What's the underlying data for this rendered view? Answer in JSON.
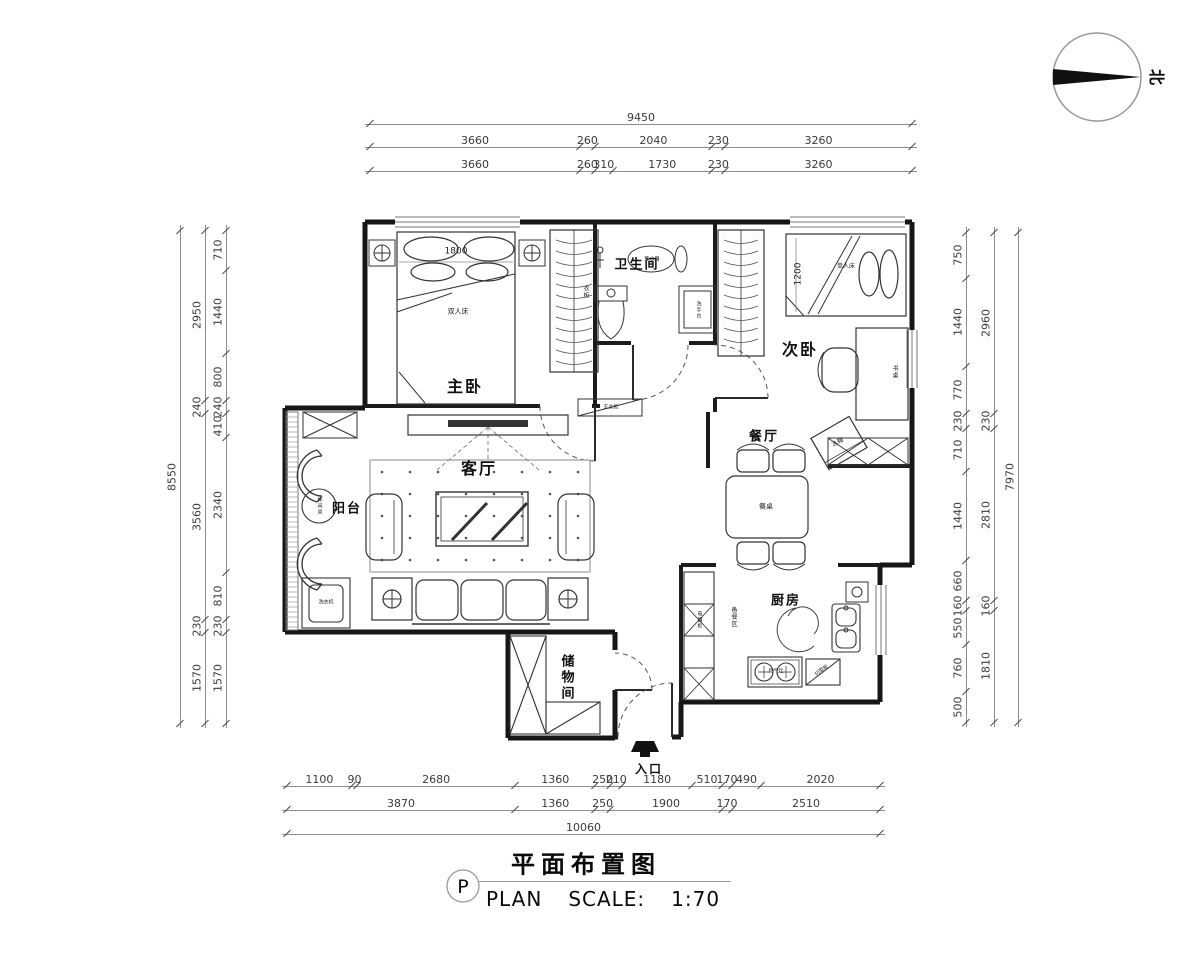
{
  "meta": {
    "background": "#ffffff",
    "ink_color": "#161616",
    "dim_text_color": "#3a3a3a",
    "dim_line_color": "#8c8c8c"
  },
  "north": {
    "label": "北"
  },
  "title_block": {
    "letter": "P",
    "title_cn": "平面布置图",
    "plan_label": "PLAN",
    "scale_label": "SCALE:",
    "scale_value": "1:70"
  },
  "dimensions": {
    "top": {
      "total": [
        "9450"
      ],
      "row2": [
        "3660",
        "260",
        "2040",
        "230",
        "3260"
      ],
      "row3": [
        "3660",
        "260",
        "310",
        "1730",
        "230",
        "3260"
      ]
    },
    "bottom": {
      "row1": [
        "1100",
        "90",
        "2680",
        "1360",
        "250",
        "210",
        "1180",
        "510",
        "170",
        "490",
        "2020"
      ],
      "row2": [
        "3870",
        "1360",
        "250",
        "1900",
        "170",
        "2510"
      ],
      "total": [
        "10060"
      ]
    },
    "left": {
      "total": [
        "8550"
      ],
      "mid": [
        "2950",
        "240",
        "3560",
        "230",
        "1570"
      ],
      "inner": [
        "710",
        "1440",
        "800",
        "240",
        "410",
        "2340",
        "810",
        "230",
        "1570"
      ]
    },
    "right": {
      "inner": [
        "750",
        "1440",
        "770",
        "230",
        "710",
        "1440",
        "660",
        "160",
        "550",
        "760",
        "500"
      ],
      "mid": [
        "2960",
        "230",
        "2810",
        "160",
        "1810"
      ],
      "total": [
        "7970"
      ]
    }
  },
  "rooms": {
    "master": "主卧",
    "bathroom": "卫生间",
    "second": "次卧",
    "living": "客厅",
    "dining": "餐厅",
    "kitchen": "厨房",
    "storage": "储物间",
    "balcony": "阳台",
    "entrance": "入口"
  },
  "furniture": {
    "double_bed": "双人床",
    "double_bed_width": "1800",
    "wardrobe": "衣柜",
    "single_bed": "单人床",
    "single_bed_width": "1200",
    "desk": "书桌",
    "dining_table": "餐桌",
    "fridge": "冰箱",
    "leisure_table": "休闲桌",
    "prep_area": "备餐区",
    "appliance_cabinet": "电器柜",
    "gas_stove": "燃气灶",
    "cutting_board": "切菜板",
    "wash_basin": "洗手台",
    "water_heater": "热水器",
    "washing_machine": "洗衣机",
    "entry_cabinet": "玄关柜"
  }
}
